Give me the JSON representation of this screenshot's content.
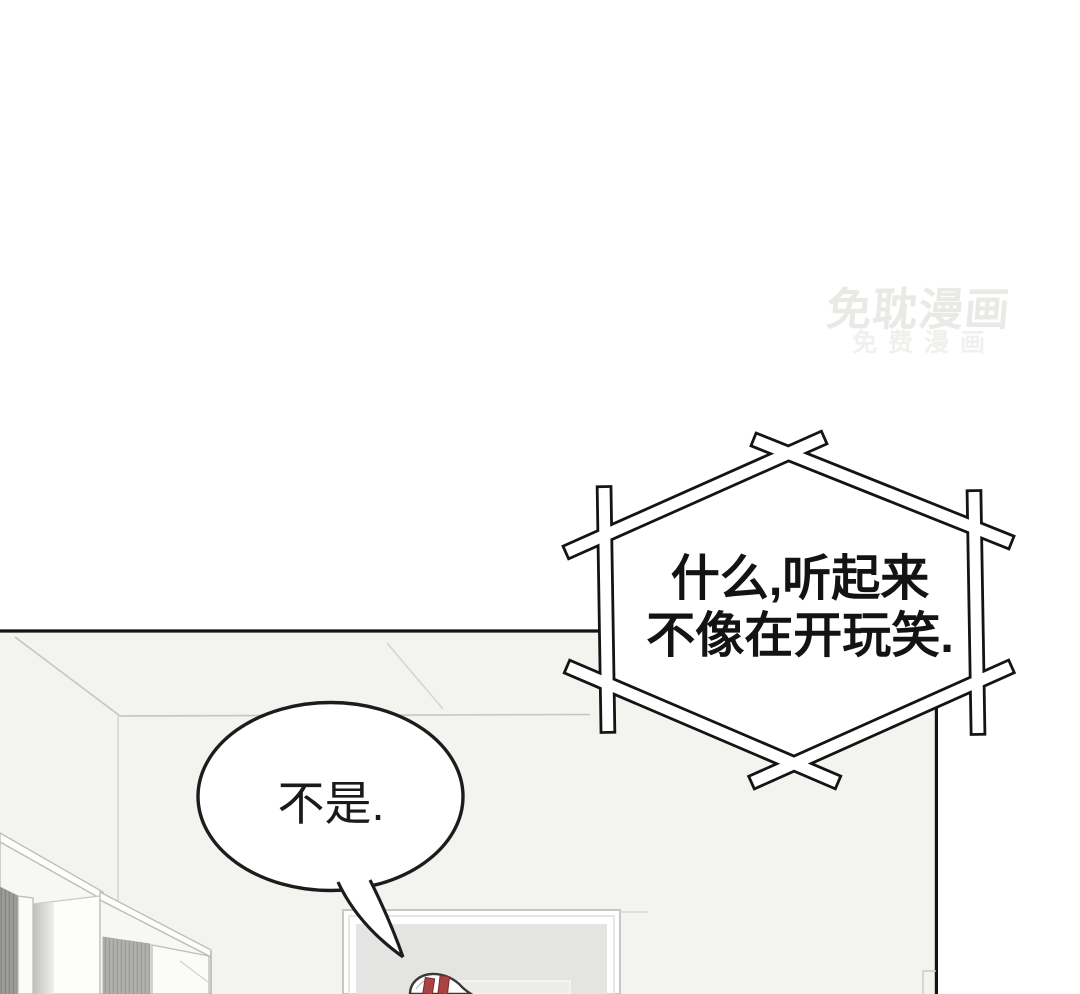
{
  "page": {
    "type": "manhua-comic-panel"
  },
  "watermark": {
    "line1": "免耽漫画",
    "line2": "免费漫画",
    "color": "#e9e9e6"
  },
  "bubbles": {
    "shout": {
      "shape": "crossed-stick-hexagon",
      "line1": "什么,听起来",
      "line2": "不像在开玩笑."
    },
    "reply": {
      "shape": "ellipse-with-tail",
      "text": "不是."
    }
  },
  "scene": {
    "elements": [
      "room-ceiling-corner",
      "wardrobe-left",
      "wardrobe-right",
      "picture-frame",
      "red-marked-object"
    ]
  },
  "colors": {
    "page_bg": "#ffffff",
    "panel_bg": "#f3f3ef",
    "ink": "#141414",
    "sketch_gray": "#c6c6c1",
    "red_accent": "#a84444"
  }
}
